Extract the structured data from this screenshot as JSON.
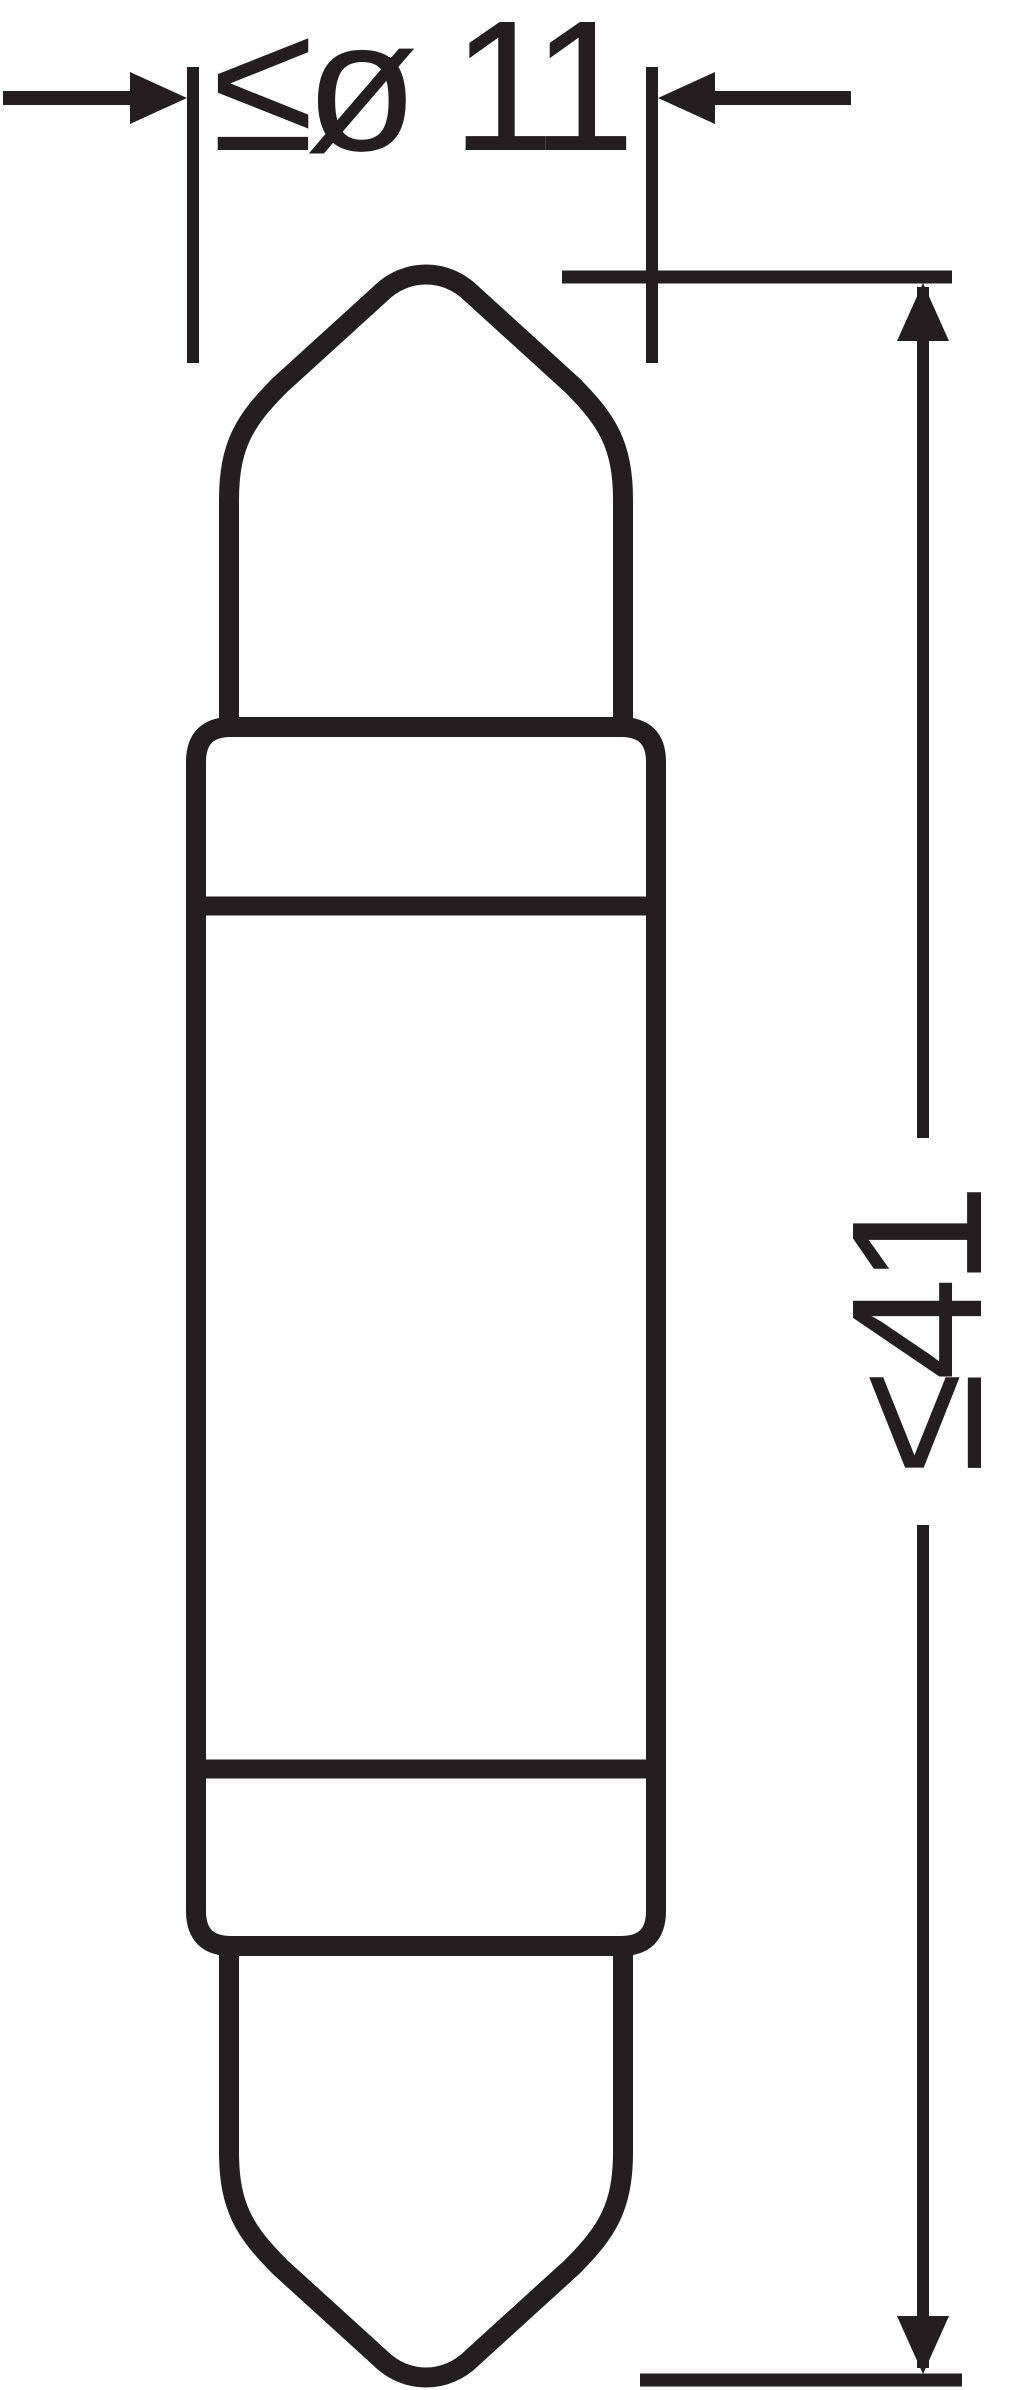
{
  "colors": {
    "ink": "#231f20",
    "background": "#ffffff"
  },
  "drawing": {
    "type": "technical-dimension-drawing",
    "subject": "festoon-bulb-side-view",
    "dimensions": {
      "diameter": {
        "label": "≤ø 11",
        "value": 11,
        "constraint": "max",
        "orientation": "horizontal"
      },
      "length": {
        "label": "≤41",
        "value": 41,
        "constraint": "max",
        "orientation": "vertical"
      }
    }
  }
}
